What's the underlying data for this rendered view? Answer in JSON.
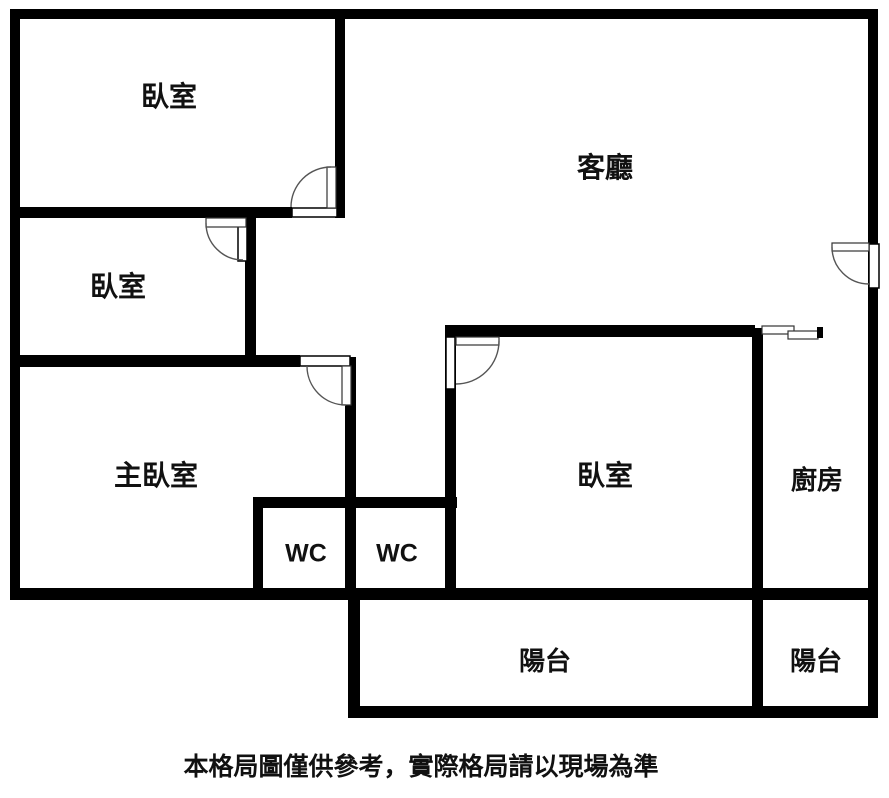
{
  "colors": {
    "wall": "#000000",
    "background": "#ffffff",
    "label": "#111111",
    "door_line": "#555555"
  },
  "floorplan": {
    "rooms": [
      {
        "id": "bedroom-top-left",
        "label": "臥室"
      },
      {
        "id": "living-room",
        "label": "客廳"
      },
      {
        "id": "bedroom-mid-left",
        "label": "臥室"
      },
      {
        "id": "master-bedroom",
        "label": "主臥室"
      },
      {
        "id": "bedroom-right",
        "label": "臥室"
      },
      {
        "id": "kitchen",
        "label": "廚房"
      },
      {
        "id": "wc-1",
        "label": "WC"
      },
      {
        "id": "wc-2",
        "label": "WC"
      },
      {
        "id": "balcony-main",
        "label": "陽台"
      },
      {
        "id": "balcony-kitchen",
        "label": "陽台"
      }
    ],
    "caption": "本格局圖僅供參考，實際格局請以現場為準"
  }
}
